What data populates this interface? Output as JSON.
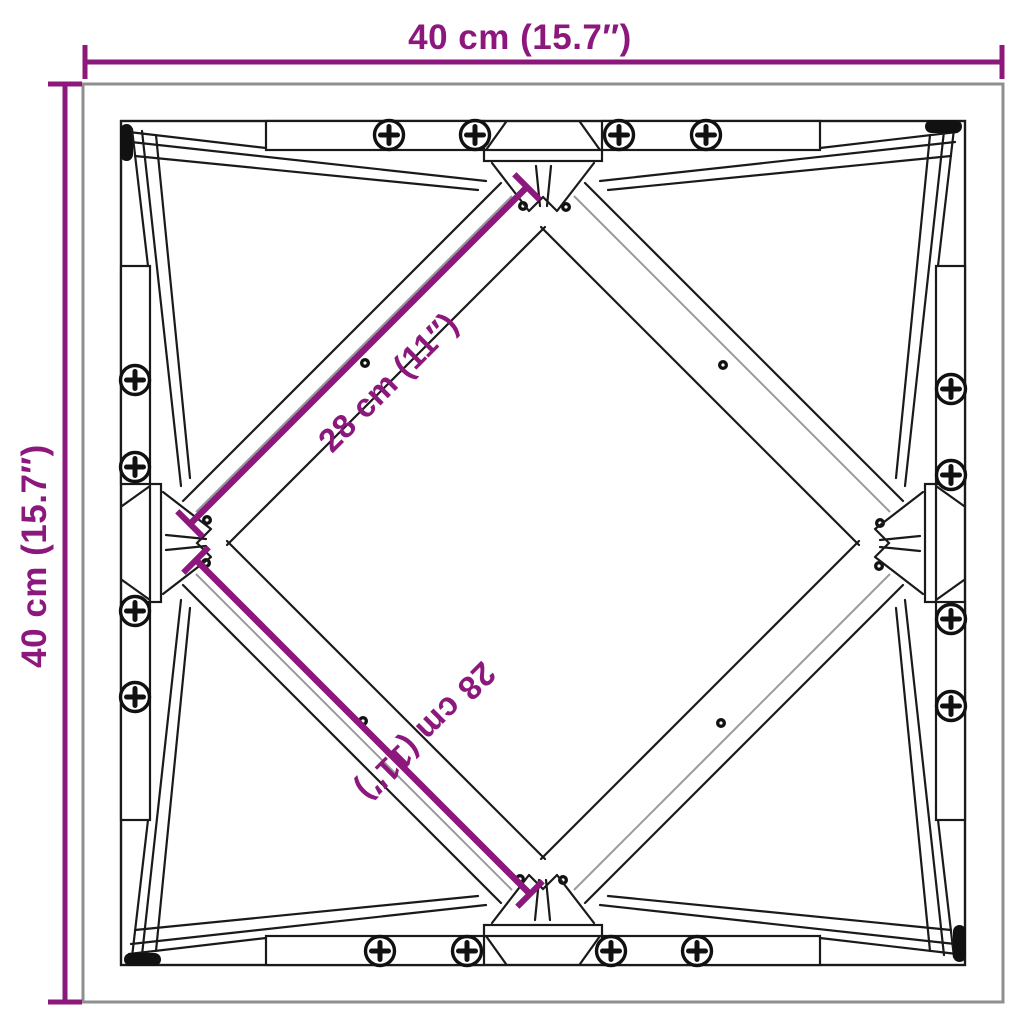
{
  "diagram": {
    "type": "product-dimension-drawing",
    "subject": "square table frame with diagonal cross braces and screws",
    "dimensions": {
      "width": {
        "label": "40 cm (15.7″)",
        "orientation": "horizontal-top"
      },
      "height": {
        "label": "40 cm (15.7″)",
        "orientation": "vertical-left"
      },
      "brace_upper": {
        "label": "28 cm (11″)",
        "orientation": "diagonal-45"
      },
      "brace_lower": {
        "label": "28 cm (11″)",
        "orientation": "diagonal-135"
      }
    },
    "colors": {
      "dimension_accent": "#8D187D",
      "line": "#1a1a1a",
      "outer_edge": "#8f8f8f",
      "board_shading": "#9a9a9a",
      "background": "#ffffff"
    },
    "counts": {
      "phillips_screws": 16,
      "pilot_hole_dots": 12
    }
  }
}
